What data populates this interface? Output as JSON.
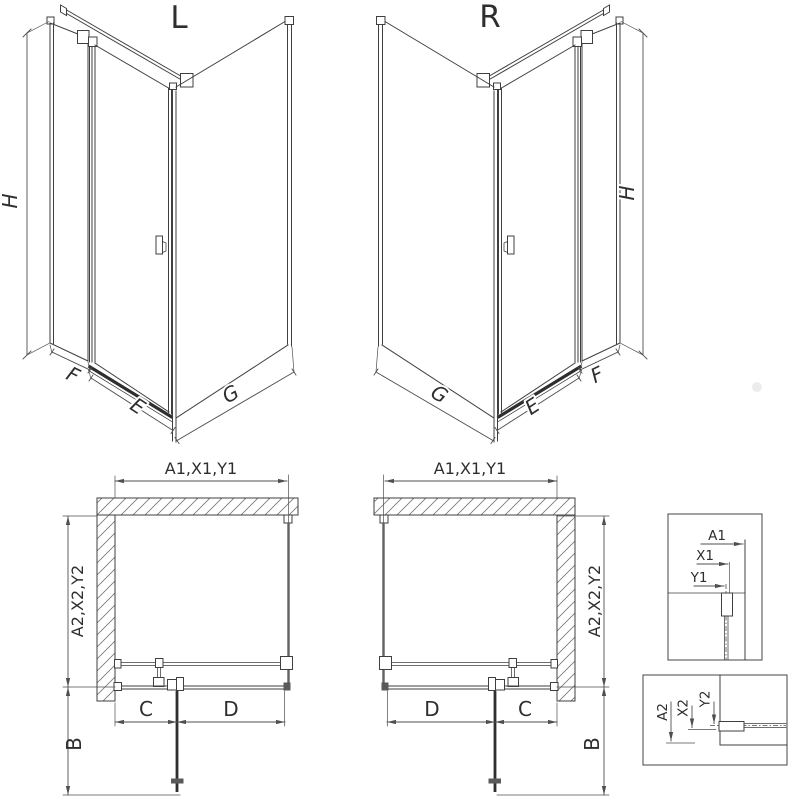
{
  "iso_left": {
    "title": "L",
    "dim_height": "H",
    "dim_side_panel": "F",
    "dim_door": "E",
    "dim_return_panel": "G"
  },
  "iso_right": {
    "title": "R",
    "dim_height": "H",
    "dim_side_panel": "F",
    "dim_door": "E",
    "dim_return_panel": "G"
  },
  "plan_left": {
    "dim_top": "A1,X1,Y1",
    "dim_side": "A2,X2,Y2",
    "dim_fixed": "C",
    "dim_door": "D",
    "dim_depth": "B"
  },
  "plan_right": {
    "dim_top": "A1,X1,Y1",
    "dim_side": "A2,X2,Y2",
    "dim_fixed": "C",
    "dim_door": "D",
    "dim_depth": "B"
  },
  "detail_top": {
    "dim_a": "A1",
    "dim_x": "X1",
    "dim_y": "Y1"
  },
  "detail_bottom": {
    "dim_a": "A2",
    "dim_x": "X2",
    "dim_y": "Y2"
  },
  "colors": {
    "line": "#3f3f3f",
    "dim": "#4f4f4f",
    "door": "#2e2e2e",
    "hatch": "#777777",
    "background": "#ffffff"
  }
}
